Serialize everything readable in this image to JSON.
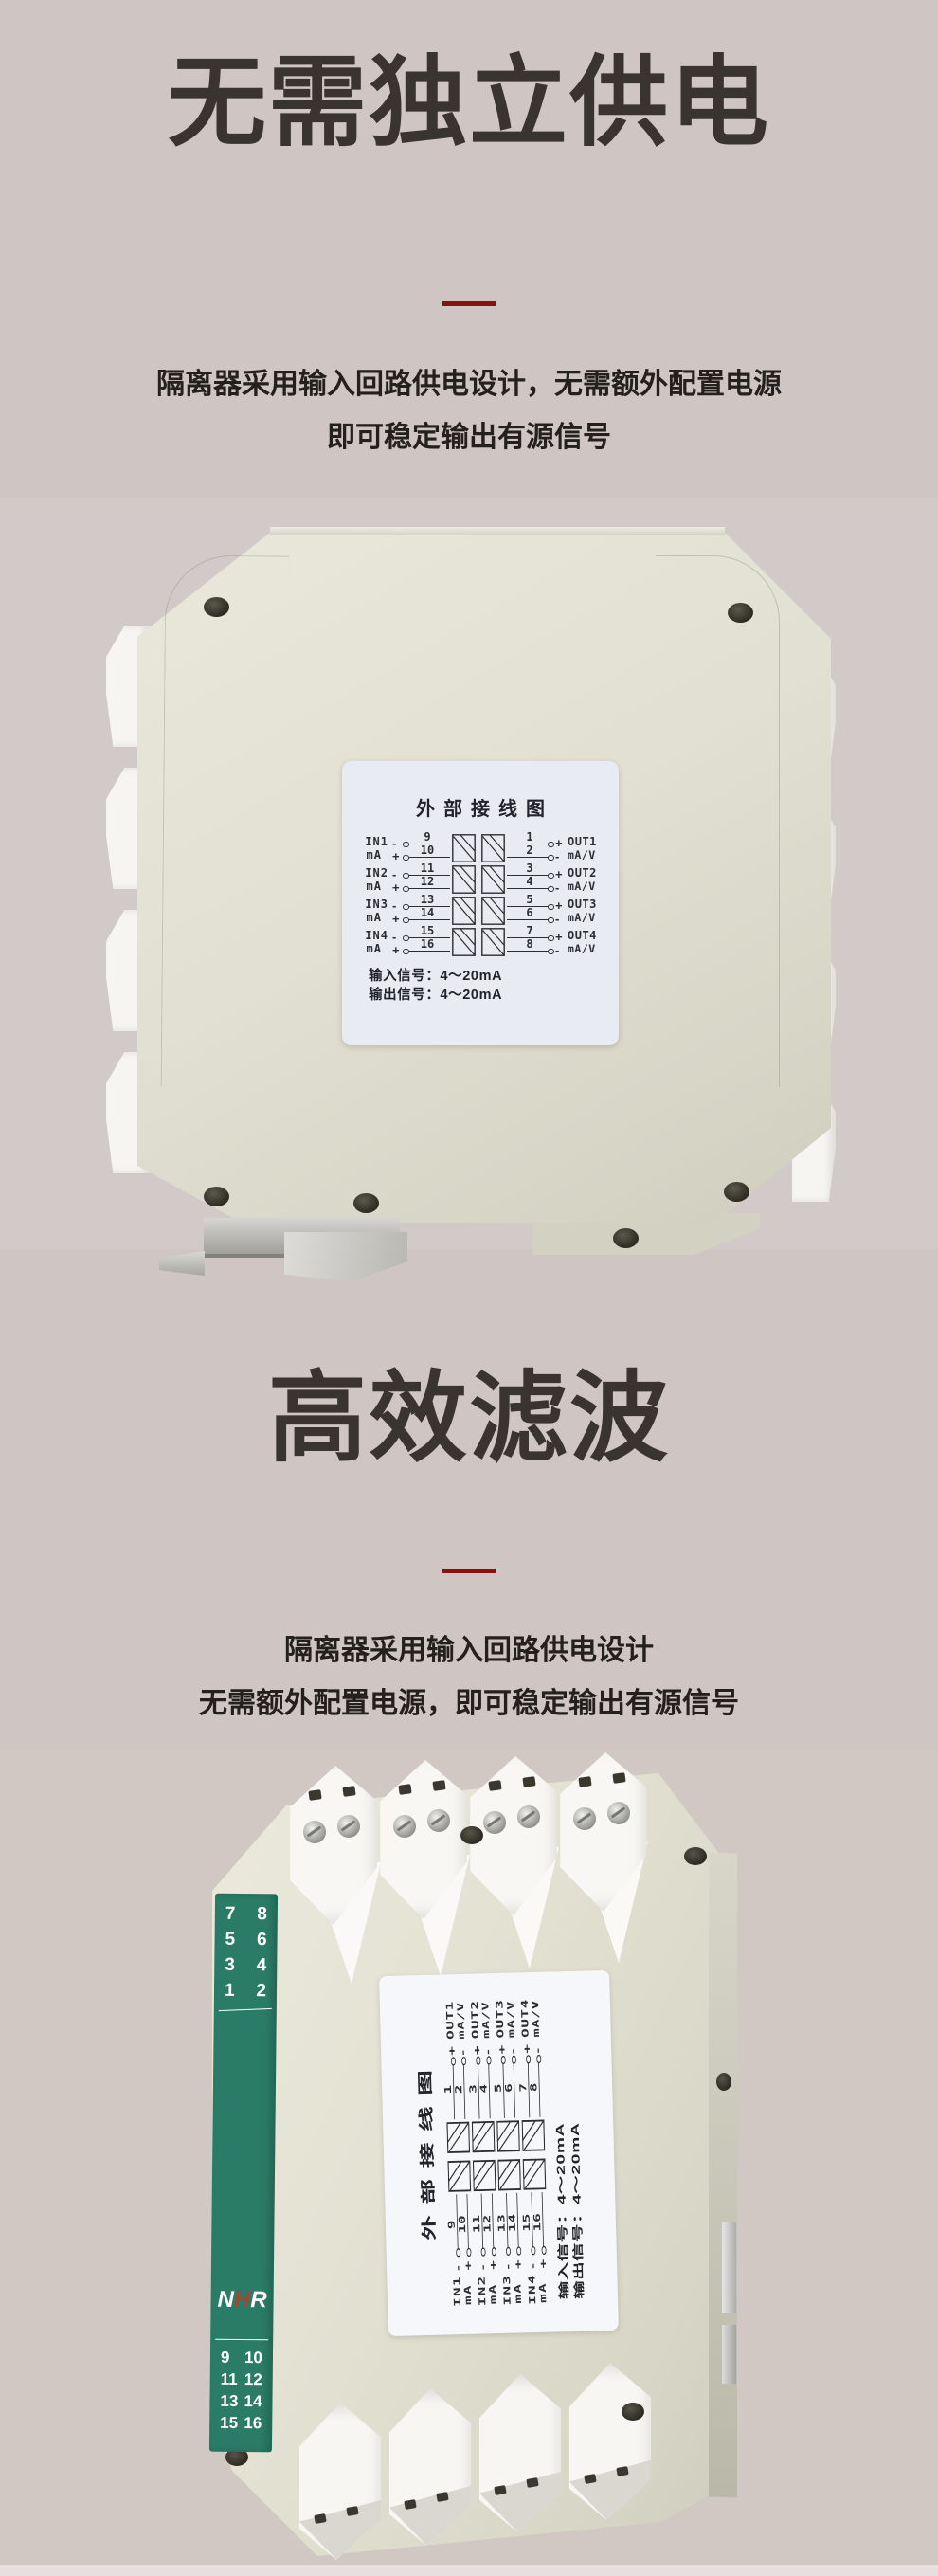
{
  "colors": {
    "page_bg": "#cfc6c4",
    "photo1_bg": "#d2cac8",
    "photo2_bg": "#d1c7c3",
    "divider_red": "#8a1013",
    "heading_text": "#39342f",
    "body_text": "#24201e",
    "device_body": "#e3e1d3",
    "green_strip": "#2b7c66",
    "logo_red": "#a84334",
    "label_bg": "#e9ebf3",
    "diagram_ink": "#2d2d34"
  },
  "section1": {
    "heading": "无需独立供电",
    "desc_line1": "隔离器采用输入回路供电设计，无需额外配置电源",
    "desc_line2": "即可稳定输出有源信号"
  },
  "section2": {
    "heading": "高效滤波",
    "desc_line1": "隔离器采用输入回路供电设计",
    "desc_line2": "无需额外配置电源，即可稳定输出有源信号"
  },
  "wiring": {
    "title": "外部接线图",
    "signs": {
      "in_top": "-",
      "in_bot": "+",
      "out_top": "+",
      "out_bot": "-"
    },
    "channels": [
      {
        "in_name": "IN1",
        "in_unit": "mA",
        "t_in_top": "9",
        "t_in_bot": "10",
        "t_out_top": "1",
        "t_out_bot": "2",
        "out_name": "OUT1",
        "out_unit": "mA/V"
      },
      {
        "in_name": "IN2",
        "in_unit": "mA",
        "t_in_top": "11",
        "t_in_bot": "12",
        "t_out_top": "3",
        "t_out_bot": "4",
        "out_name": "OUT2",
        "out_unit": "mA/V"
      },
      {
        "in_name": "IN3",
        "in_unit": "mA",
        "t_in_top": "13",
        "t_in_bot": "14",
        "t_out_top": "5",
        "t_out_bot": "6",
        "out_name": "OUT3",
        "out_unit": "mA/V"
      },
      {
        "in_name": "IN4",
        "in_unit": "mA",
        "t_in_top": "15",
        "t_in_bot": "16",
        "t_out_top": "7",
        "t_out_bot": "8",
        "out_name": "OUT4",
        "out_unit": "mA/V"
      }
    ],
    "input_signal": "输入信号：4～20mA",
    "output_signal": "输出信号：4～20mA"
  },
  "device2": {
    "top_rows": [
      {
        "l": "7",
        "r": "8"
      },
      {
        "l": "5",
        "r": "6"
      },
      {
        "l": "3",
        "r": "4"
      },
      {
        "l": "1",
        "r": "2"
      }
    ],
    "logo": {
      "n": "N",
      "h": "H",
      "r": "R"
    },
    "bottom_rows": [
      {
        "l": "9",
        "r": "10"
      },
      {
        "l": "11",
        "r": "12"
      },
      {
        "l": "13",
        "r": "14"
      },
      {
        "l": "15",
        "r": "16"
      }
    ]
  }
}
